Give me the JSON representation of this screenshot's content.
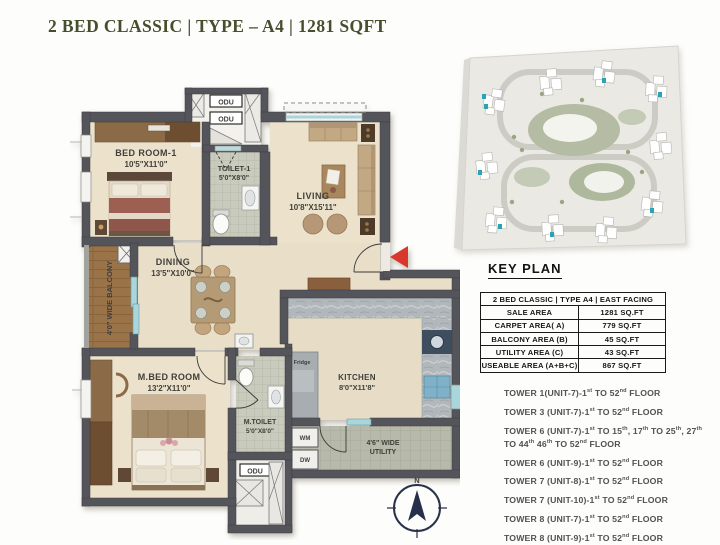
{
  "title": "2 BED CLASSIC | TYPE – A4 | 1281 SQFT",
  "key_plan": {
    "heading": "KEY PLAN",
    "table": {
      "header": "2 BED CLASSIC | TYPE A4 | EAST FACING",
      "rows": [
        {
          "label": "SALE AREA",
          "value": "1281 SQ.FT"
        },
        {
          "label": "CARPET AREA( A)",
          "value": "779 SQ.FT"
        },
        {
          "label": "BALCONY AREA (B)",
          "value": "45 SQ.FT"
        },
        {
          "label": "UTILITY AREA (C)",
          "value": "43 SQ.FT"
        },
        {
          "label": "USEABLE AREA (A+B+C)",
          "value": "867 SQ.FT"
        }
      ]
    },
    "towers": [
      "TOWER 1(UNIT-7)-1st TO 52nd FLOOR",
      "TOWER 3 (UNIT-7)-1st TO 52nd FLOOR",
      "TOWER 6 (UNIT-7)-1st TO 15th, 17th TO 25th, 27th TO 44th 46th TO 52nd FLOOR",
      "TOWER 6 (UNIT-9)-1st TO 52nd FLOOR",
      "TOWER 7 (UNIT-8)-1st TO 52nd FLOOR",
      "TOWER 7 (UNIT-10)-1st TO 52nd FLOOR",
      "TOWER 8 (UNIT-7)-1st TO 52nd FLOOR",
      "TOWER 8 (UNIT-9)-1st TO 52nd FLOOR"
    ]
  },
  "plan": {
    "rooms": {
      "bedroom1": {
        "name": "BED ROOM-1",
        "dim": "10'5\"X11'0\""
      },
      "toilet1": {
        "name": "TOILET-1",
        "dim": "5'0\"X8'0\""
      },
      "living": {
        "name": "LIVING",
        "dim": "10'8\"X15'11\""
      },
      "dining": {
        "name": "DINING",
        "dim": "13'5\"X10'0\""
      },
      "master_bedroom": {
        "name": "M.BED ROOM",
        "dim": "13'2\"X11'0\""
      },
      "master_toilet": {
        "name": "M.TOILET",
        "dim": "5'0\"X8'0\""
      },
      "kitchen": {
        "name": "KITCHEN",
        "dim": "8'0\"X11'8\""
      },
      "balcony": {
        "name": "4'0\" WIDE BALCONY"
      },
      "utility": {
        "line1": "4'6\" WIDE",
        "line2": "UTILITY"
      }
    },
    "fixtures": {
      "odu": "ODU",
      "fridge": "Fridge",
      "wm": "WM",
      "dw": "DW"
    },
    "compass_north": "N"
  },
  "colors": {
    "accent_red": "#d8382c",
    "title_green": "#474e2e",
    "compass_navy": "#26304a",
    "unit_teal": "#2ba3b4"
  }
}
